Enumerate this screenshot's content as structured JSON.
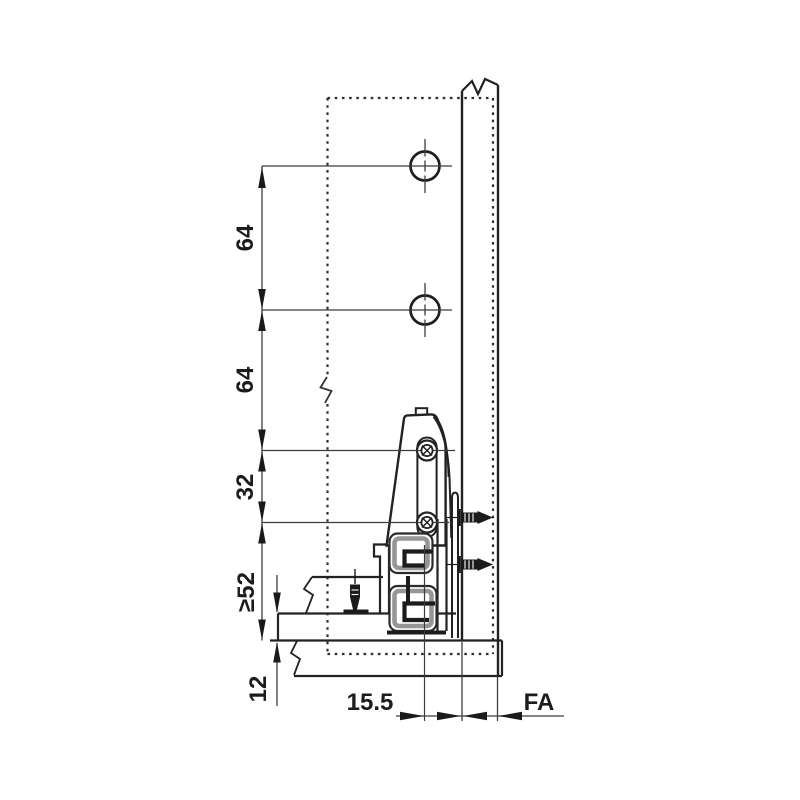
{
  "diagram": {
    "description_labels": {
      "hole_spacing_upper": "64",
      "hole_spacing_lower": "64",
      "bracket_screw_spacing": "32",
      "min_bottom_clearance": "≥52",
      "drawer_bottom_thickness": "12",
      "axis_to_front_distance": "15.5",
      "front_overlay": "FA"
    },
    "colors": {
      "ink": "#1f1f1f",
      "thin_line": "#3c3c3c",
      "profile_gray": "#969696"
    }
  }
}
